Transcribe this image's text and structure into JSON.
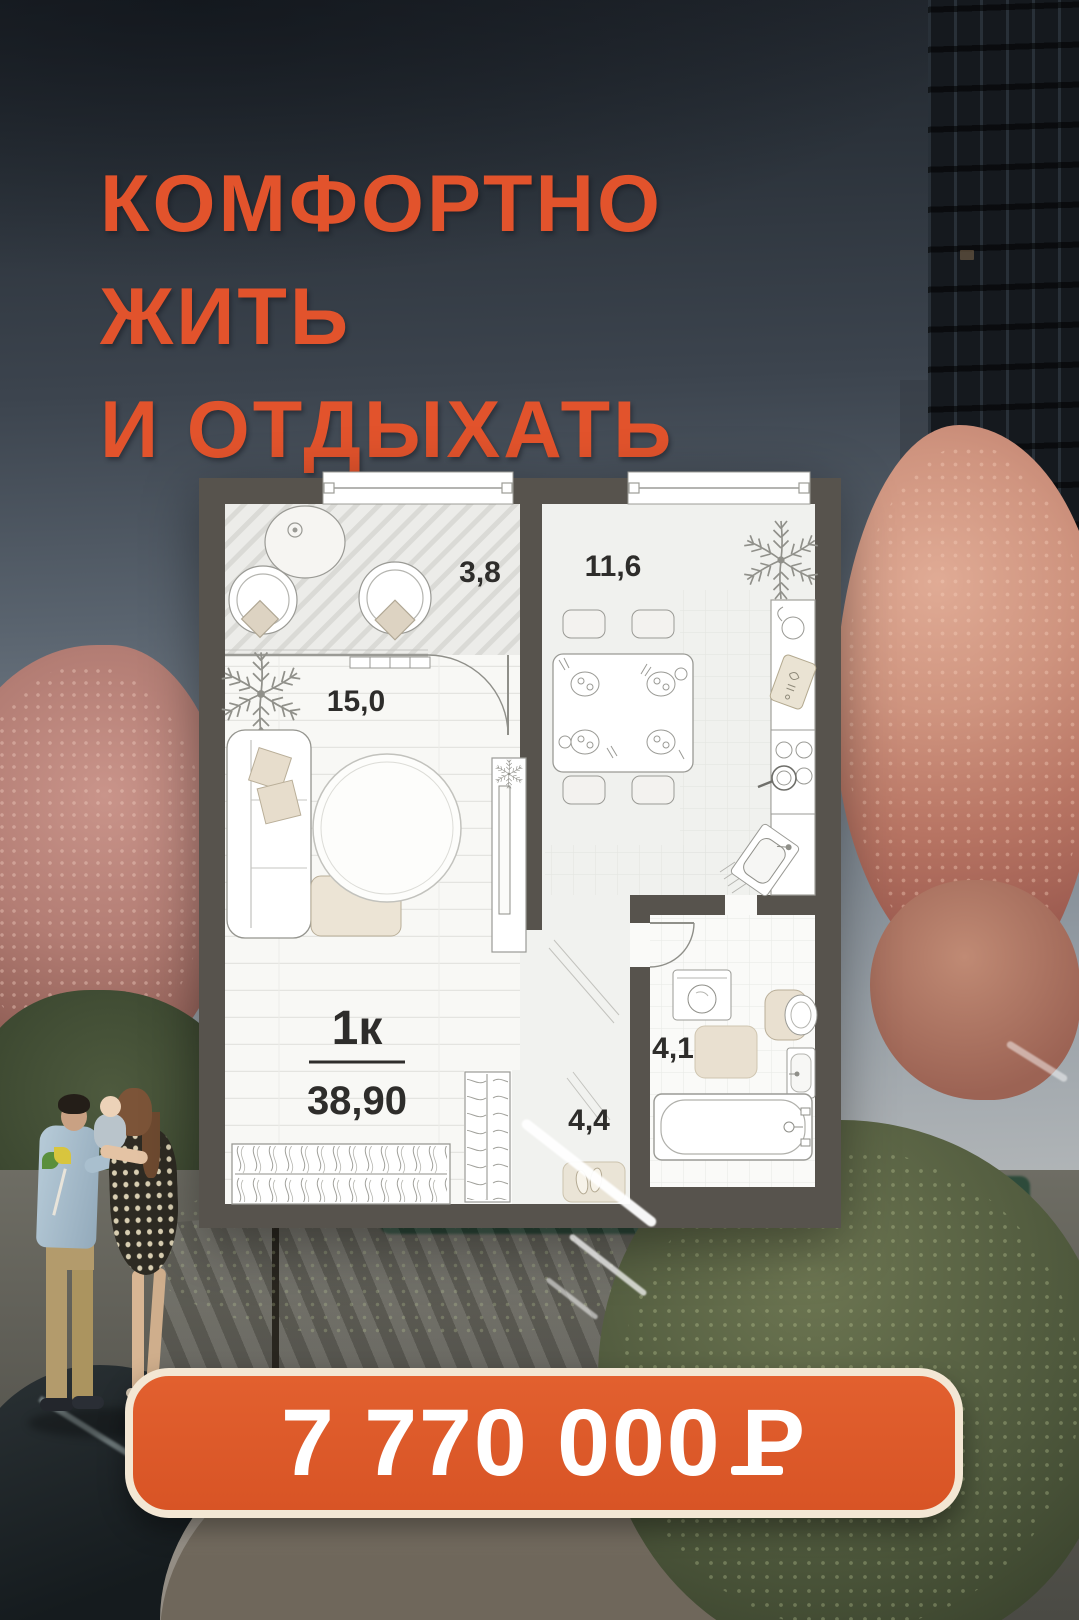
{
  "headline": {
    "lines": [
      "КОМФОРТНО",
      "ЖИТЬ",
      "И ОТДЫХАТЬ"
    ]
  },
  "floor_plan": {
    "apartment_type_label": "1к",
    "total_area_label": "38,90",
    "rooms": [
      {
        "name": "loggia",
        "area_label": "3,8"
      },
      {
        "name": "kitchen",
        "area_label": "11,6"
      },
      {
        "name": "living-room",
        "area_label": "15,0"
      },
      {
        "name": "bathroom",
        "area_label": "4,1"
      },
      {
        "name": "hallway",
        "area_label": "4,4"
      }
    ]
  },
  "price_badge": {
    "amount": "7 770 000",
    "currency": "₽",
    "currency_glyph": "Р"
  },
  "colors": {
    "accent_orange": "#e2532c",
    "badge_orange": "#dd5a2a",
    "badge_border": "#f3e7d4",
    "plan_wall": "#57534d"
  }
}
